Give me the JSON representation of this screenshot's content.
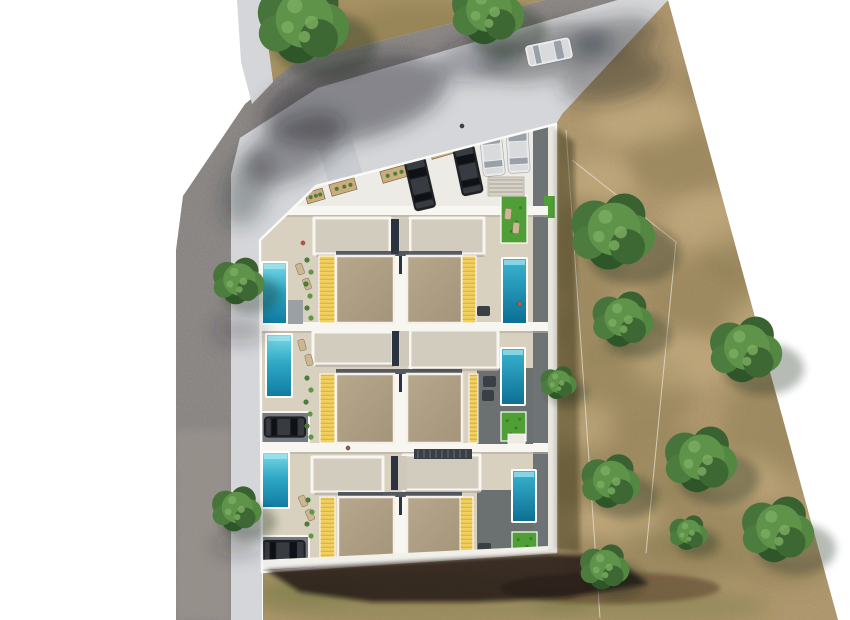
{
  "meta": {
    "description": "Aerial 3D render of a residential development: three rows of paired townhouses with private pools, yellow pergolas, roof terraces, a parking forecourt with cars, an L-shaped street with sidewalks, and a dry scrubland field with trees on the right.",
    "canvas": {
      "w": 850,
      "h": 620
    }
  },
  "palette": {
    "bg": "#ffffff",
    "asphalt": "#8d8987",
    "asphalt_low": "#a59c94",
    "sidewalk": "#d5d6d9",
    "apron": "#c9ccd0",
    "dirt": "#b39970",
    "dirt_top": "#ab9365",
    "dirt_dark": "#6f6a3d",
    "dirt_light": "#dcc493",
    "green_tint": "#5f6b33",
    "plot_concrete": "#ecebe6",
    "terrace": "#d9d1c0",
    "slab": "#d2ccbe",
    "wall_white": "#f8f6f1",
    "roof_a": "#b7a88d",
    "roof_b": "#a3947a",
    "yellow": "#f2cf5e",
    "yellow_slat": "#d6b143",
    "pool_light": "#7edbe8",
    "pool_mid": "#2fa9c6",
    "pool_deep": "#0f7ba0",
    "pool2_light": "#3ab6d2",
    "pool2_deep": "#0c6e92",
    "grass": "#4f9e36",
    "deck_dark": "#6e7476",
    "patio_dark": "#6b7170",
    "patio_gray": "#9aa0a4",
    "garage_floor": "#747a80",
    "car_dark_body": "#1f2125",
    "car_dark_glass": "#0e1116",
    "car_dark_roof": "#383b41",
    "car_white_body": "#e9eaec",
    "car_white_glass": "#99a0a8",
    "car_white_roof": "#d8dadc",
    "planter": "#c9ad7e",
    "lounger": "#cbb794",
    "sofa": "#3a3f45",
    "shadow": "#16120b",
    "gap_dark": "#2b3240",
    "band_shadow": "#b3ab9c",
    "tree_greens": [
      "#47743b",
      "#3a6230",
      "#548742",
      "#2f5628",
      "#4c7c3e",
      "#5e9349",
      "#3d6833"
    ],
    "tree_highlight": "#79aa5f",
    "tree_shadow": "#232a12",
    "fence": "#ece8dc"
  },
  "scene": {
    "trees": [
      [
        302,
        20,
        48
      ],
      [
        487,
        10,
        38
      ],
      [
        238,
        280,
        27
      ],
      [
        236,
        508,
        26
      ],
      [
        612,
        230,
        44
      ],
      [
        622,
        318,
        32
      ],
      [
        745,
        348,
        38
      ],
      [
        700,
        458,
        38
      ],
      [
        610,
        480,
        31
      ],
      [
        777,
        528,
        38
      ],
      [
        688,
        532,
        20
      ],
      [
        604,
        566,
        26
      ],
      [
        558,
        382,
        19
      ]
    ],
    "road_shadows": [
      [
        355,
        100,
        95,
        40,
        -14,
        0.45
      ],
      [
        295,
        148,
        55,
        28,
        -30,
        0.42
      ],
      [
        248,
        188,
        40,
        22,
        -70,
        0.32
      ],
      [
        545,
        52,
        68,
        26,
        -12,
        0.4
      ],
      [
        615,
        38,
        45,
        20,
        -12,
        0.38
      ],
      [
        478,
        58,
        42,
        22,
        -12,
        0.3
      ],
      [
        612,
        78,
        52,
        24,
        -12,
        0.33
      ],
      [
        240,
        330,
        26,
        14,
        0,
        0.25
      ],
      [
        238,
        545,
        24,
        12,
        0,
        0.25
      ]
    ],
    "topdirt_blobs": [
      [
        300,
        30,
        60,
        25
      ],
      [
        420,
        25,
        70,
        22
      ],
      [
        360,
        62,
        50,
        18
      ]
    ],
    "dirt_dark_blobs": [
      [
        610,
        70,
        60,
        24
      ],
      [
        680,
        160,
        55,
        35
      ],
      [
        588,
        250,
        40,
        55
      ],
      [
        700,
        300,
        60,
        40
      ],
      [
        625,
        390,
        70,
        45
      ],
      [
        580,
        480,
        50,
        30
      ],
      [
        700,
        520,
        80,
        40
      ],
      [
        768,
        430,
        45,
        55
      ],
      [
        650,
        560,
        90,
        30
      ],
      [
        780,
        565,
        50,
        22
      ],
      [
        718,
        82,
        40,
        20
      ],
      [
        600,
        330,
        45,
        30
      ],
      [
        660,
        460,
        55,
        35
      ],
      [
        740,
        250,
        40,
        30
      ]
    ],
    "dirt_light_blobs": [
      [
        640,
        120,
        50,
        25
      ],
      [
        710,
        220,
        45,
        28
      ],
      [
        600,
        180,
        35,
        22
      ],
      [
        680,
        360,
        50,
        30
      ],
      [
        745,
        480,
        40,
        25
      ],
      [
        620,
        520,
        45,
        22
      ],
      [
        580,
        420,
        35,
        20
      ],
      [
        760,
        330,
        35,
        35
      ],
      [
        800,
        540,
        35,
        25
      ]
    ],
    "green_blobs": [
      [
        420,
        600,
        170,
        26
      ],
      [
        650,
        606,
        120,
        18
      ],
      [
        300,
        588,
        60,
        16
      ]
    ],
    "fences": [
      [
        566,
        130,
        600,
        618
      ],
      [
        572,
        160,
        676,
        242
      ],
      [
        676,
        242,
        646,
        553
      ]
    ],
    "people": [
      [
        303,
        243,
        "#c94b42"
      ],
      [
        348,
        448,
        "#8a5a4a"
      ],
      [
        462,
        126,
        "#3c4046"
      ],
      [
        520,
        304,
        "#c95a42"
      ]
    ],
    "parking": {
      "dark_cars": [
        [
          420,
          184,
          22,
          52,
          -13
        ],
        [
          468,
          170,
          22,
          50,
          -12
        ]
      ],
      "white_cars": [
        [
          492,
          151,
          22,
          50,
          -6
        ],
        [
          518,
          148,
          22,
          50,
          -3
        ]
      ],
      "road_car": [
        549,
        52,
        22,
        46,
        78
      ],
      "planters": [
        [
          343,
          187,
          26,
          12,
          -16
        ],
        [
          394,
          174,
          26,
          12,
          -16
        ],
        [
          443,
          150,
          26,
          12,
          -16
        ],
        [
          315,
          196,
          18,
          11,
          -16
        ]
      ],
      "stairs": [
        488,
        177,
        36,
        19
      ]
    },
    "building": {
      "bands": [
        [
          260,
          206,
          288,
          9
        ],
        [
          260,
          322,
          288,
          9
        ],
        [
          260,
          443,
          288,
          9
        ]
      ],
      "rows": [
        {
          "slabs": [
            [
              314,
              218,
              76,
              36
            ],
            [
              410,
              218,
              74,
              36
            ]
          ],
          "gap_dark": [
            391,
            219,
            8,
            35
          ],
          "gap_light": [
            400,
            219,
            9,
            35
          ],
          "roofline_shadow": [
            336,
            251,
            126,
            5
          ],
          "roofs": [
            [
              336,
              256,
              58,
              67
            ],
            [
              407,
              256,
              55,
              67
            ]
          ],
          "divider": [
            394,
            256,
            13,
            67
          ],
          "yellows": [
            [
              319,
              256,
              16,
              67
            ],
            [
              462,
              256,
              14,
              67
            ]
          ],
          "pool_left": [
            262,
            262,
            25,
            62
          ],
          "pool_right": [
            502,
            258,
            25,
            66
          ],
          "grass": [
            [
              501,
              196,
              26,
              47
            ]
          ],
          "pads": [],
          "patio_gray": [
            263,
            300,
            40,
            24
          ],
          "loungers": [
            [
              300,
              269,
              -20
            ],
            [
              307,
              284,
              -20
            ],
            [
              508,
              214,
              5
            ],
            [
              516,
              228,
              5
            ]
          ],
          "sofas": [
            [
              477,
              306,
              13,
              10
            ]
          ],
          "plants": [
            [
              307,
              260
            ],
            [
              311,
              272
            ],
            [
              306,
              284
            ],
            [
              310,
              296
            ],
            [
              307,
              308
            ],
            [
              311,
              318
            ]
          ]
        },
        {
          "slabs": [
            [
              313,
              332,
              80,
              32
            ],
            [
              410,
              330,
              88,
              38
            ]
          ],
          "gap_dark": [
            392,
            331,
            7,
            35
          ],
          "gap_light": [
            400,
            331,
            9,
            35
          ],
          "roofline_shadow": [
            336,
            369,
            126,
            5
          ],
          "roofs": [
            [
              336,
              374,
              58,
              69
            ],
            [
              407,
              374,
              55,
              69
            ]
          ],
          "divider": [
            394,
            374,
            13,
            69
          ],
          "yellows": [
            [
              320,
              374,
              15,
              69
            ],
            [
              469,
              374,
              9,
              69
            ]
          ],
          "pool_left": [
            266,
            334,
            26,
            63
          ],
          "pool_right": [
            501,
            348,
            24,
            57
          ],
          "grass": [
            [
              501,
              412,
              25,
              29
            ]
          ],
          "pads": [
            [
              508,
              434,
              17,
              10
            ]
          ],
          "patio_dark": [
            477,
            368,
            56,
            76
          ],
          "garage": {
            "nook": [
              261,
              412,
              48,
              31
            ],
            "car": [
              285,
              427,
              21,
              42,
              90
            ]
          },
          "loungers": [
            [
              302,
              345,
              -15
            ],
            [
              309,
              360,
              -15
            ]
          ],
          "sofas": [
            [
              483,
              376,
              13,
              11
            ],
            [
              482,
              390,
              12,
              11
            ]
          ],
          "plants": [
            [
              307,
              378
            ],
            [
              311,
              390
            ],
            [
              306,
              402
            ],
            [
              310,
              414
            ],
            [
              307,
              426
            ],
            [
              311,
              437
            ]
          ]
        },
        {
          "slabs": [
            [
              312,
              457,
              71,
              35
            ],
            [
              403,
              455,
              77,
              35
            ]
          ],
          "gap_dark": [
            391,
            456,
            7,
            34
          ],
          "gap_light": [
            398,
            456,
            9,
            34
          ],
          "roofline_shadow": [
            338,
            492,
            124,
            5
          ],
          "stair_dark": [
            414,
            449,
            58,
            10
          ],
          "roofs": [
            [
              338,
              497,
              56,
              62
            ],
            [
              407,
              497,
              55,
              62
            ]
          ],
          "divider": [
            394,
            497,
            13,
            62
          ],
          "yellows": [
            [
              320,
              497,
              15,
              62
            ],
            [
              460,
              497,
              13,
              62
            ]
          ],
          "pool_left": [
            262,
            452,
            27,
            56
          ],
          "pool_right": [
            512,
            470,
            24,
            52
          ],
          "grass": [
            [
              512,
              532,
              25,
              26
            ]
          ],
          "pads": [],
          "patio_dark": [
            477,
            490,
            56,
            72
          ],
          "garage": {
            "nook": [
              261,
              536,
              48,
              30
            ],
            "car": [
              284,
              551,
              22,
              43,
              90
            ]
          },
          "loungers": [
            [
              303,
              501,
              -25
            ],
            [
              310,
              515,
              -25
            ]
          ],
          "sofas": [
            [
              478,
              543,
              13,
              10
            ]
          ],
          "plants": [
            [
              308,
              500
            ],
            [
              312,
              512
            ],
            [
              307,
              524
            ],
            [
              311,
              536
            ]
          ]
        }
      ]
    }
  }
}
